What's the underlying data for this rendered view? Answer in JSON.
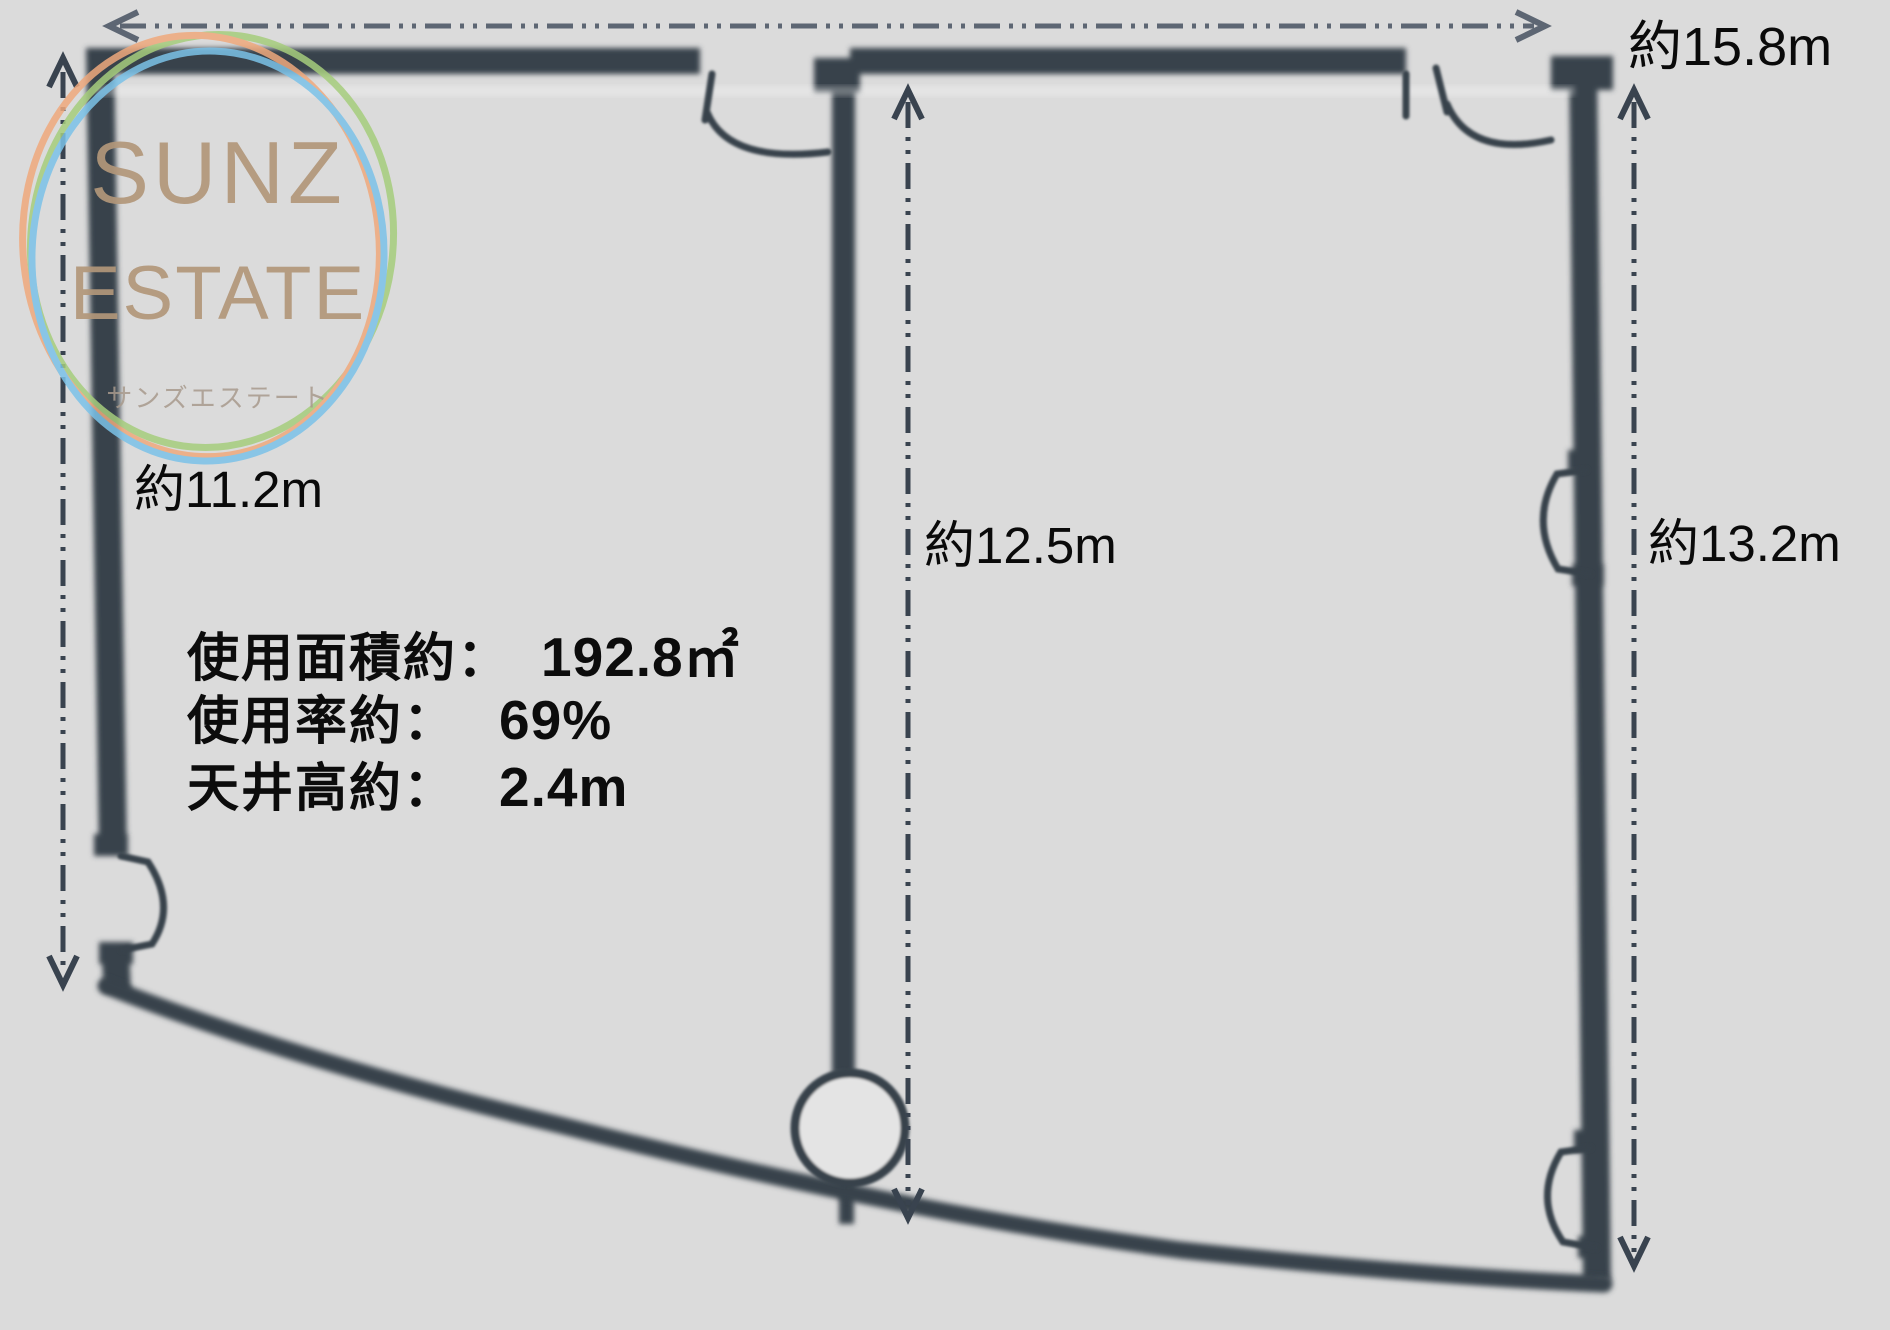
{
  "watermark": {
    "title_line1": "SUNZ",
    "title_line2": "ESTATE",
    "subtitle": "サンズエステート"
  },
  "dimension_labels": {
    "top": "約15.8m",
    "left": "約11.2m",
    "center": "約12.5m",
    "right": "約13.2m"
  },
  "specs": {
    "rows": [
      {
        "label": "使用面積約：",
        "value": "192.8㎡"
      },
      {
        "label": "使用率約：",
        "value": "69%"
      },
      {
        "label": "天井高約：",
        "value": "2.4m"
      }
    ]
  },
  "colors": {
    "background": "#dbdbdb",
    "wall": "#39424b",
    "dimension_line": "#414c5b",
    "dimension_line_top": "#5d6673",
    "text": "#0c0c0c",
    "logo_text": "#b2977a",
    "logo_ring_orange": "#efa97d",
    "logo_ring_green": "#a6cd7d",
    "logo_ring_blue": "#7bc2e8"
  }
}
